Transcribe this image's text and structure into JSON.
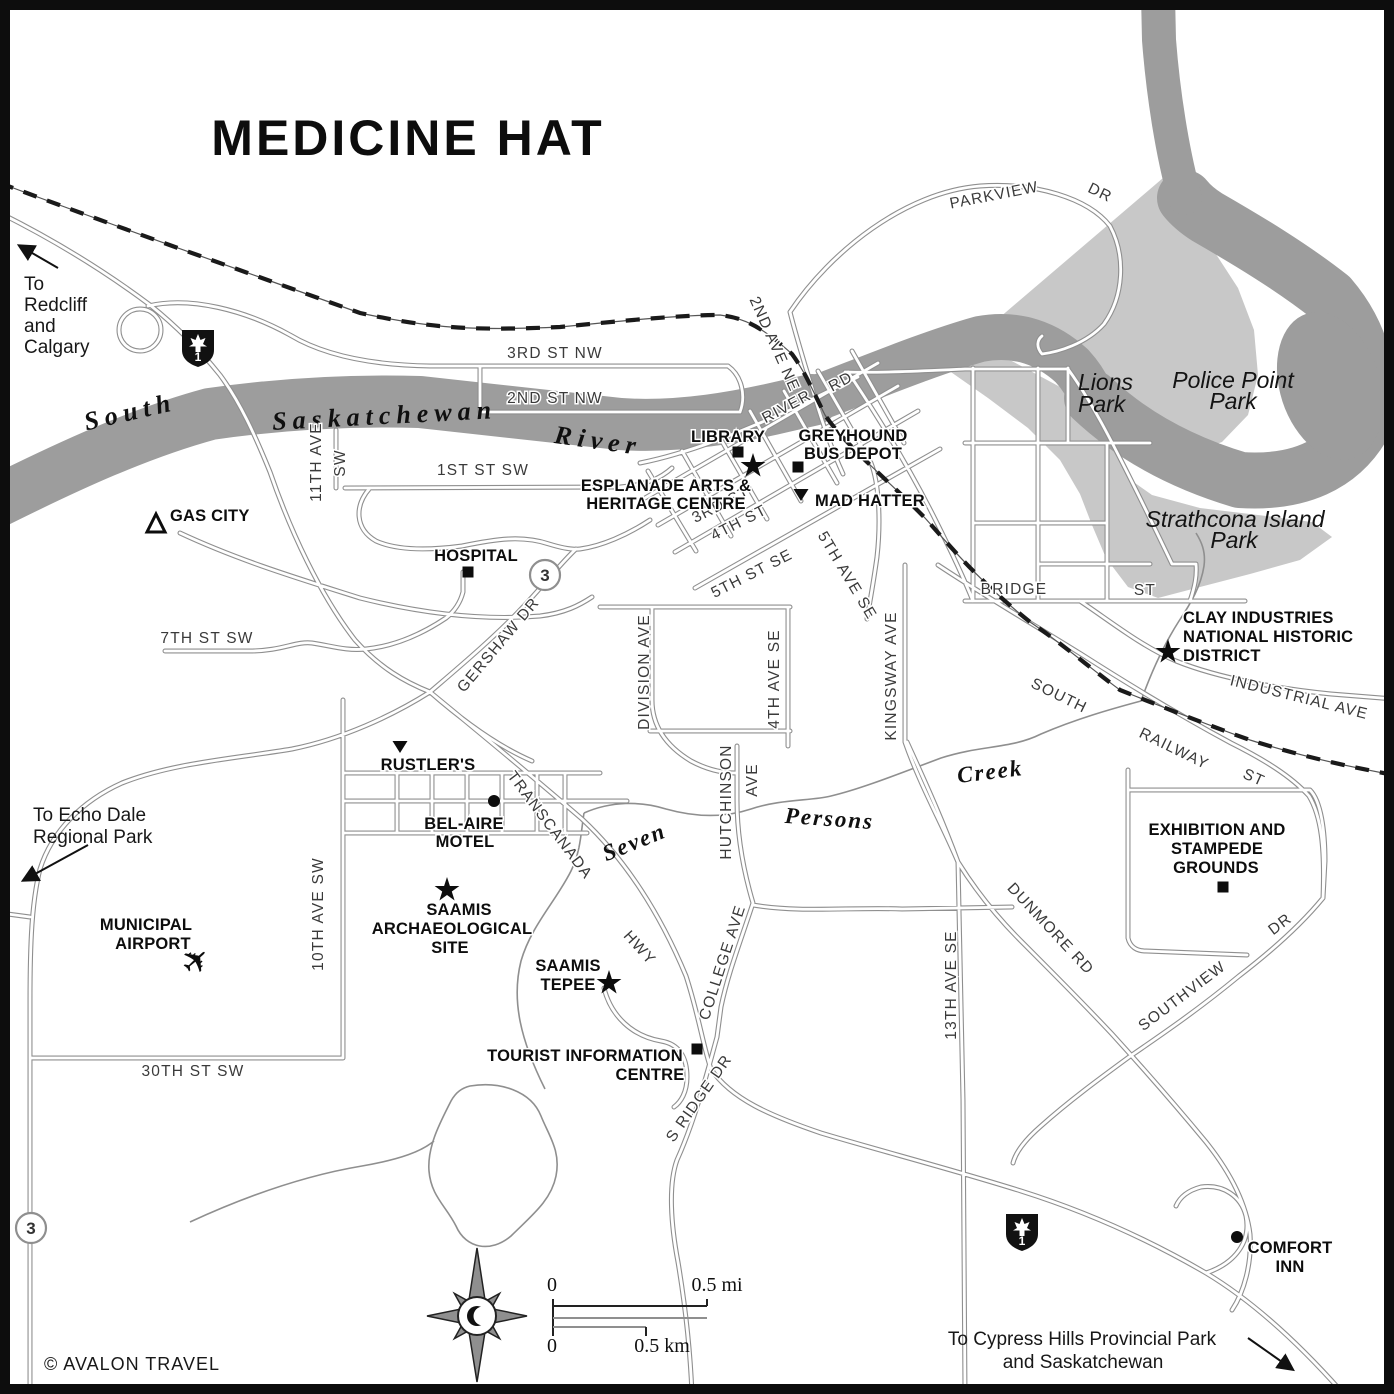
{
  "map": {
    "title": "MEDICINE HAT",
    "copyright": "© AVALON TRAVEL",
    "colors": {
      "river": "#9d9d9d",
      "park": "#c8c8c8",
      "road_casing": "#8f8f8f",
      "road_fill": "#ffffff",
      "rail": "#1a1a1a",
      "poi_text": "#0d0d0d",
      "street_text": "#3a3a3a"
    },
    "scalebar": {
      "mi_zero": "0",
      "mi_label": "0.5 mi",
      "km_zero": "0",
      "km_label": "0.5 km"
    },
    "compass": {
      "x": 477,
      "y": 1316,
      "icon": "compass-rose-crescent-moon"
    },
    "shields": [
      {
        "id": "hwy1-nw",
        "label": "1",
        "x": 198,
        "y": 348
      },
      {
        "id": "hwy1-se",
        "label": "1",
        "x": 1022,
        "y": 1232
      }
    ],
    "route_circles": [
      {
        "id": "hwy3-gershaw",
        "label": "3",
        "x": 545,
        "y": 575
      },
      {
        "id": "hwy3-south",
        "label": "3",
        "x": 31,
        "y": 1228
      }
    ],
    "arrows": [
      {
        "id": "arrow-to-redcliff",
        "x1": 58,
        "y1": 268,
        "x2": 20,
        "y2": 246
      },
      {
        "id": "arrow-to-echo-dale",
        "x1": 88,
        "y1": 845,
        "x2": 24,
        "y2": 880
      },
      {
        "id": "arrow-to-cypress",
        "x1": 1248,
        "y1": 1338,
        "x2": 1292,
        "y2": 1369
      }
    ],
    "markers": [
      {
        "type": "square",
        "name": "library-marker",
        "x": 738,
        "y": 452
      },
      {
        "type": "square",
        "name": "greyhound-bus-depot-marker",
        "x": 798,
        "y": 467
      },
      {
        "type": "square",
        "name": "hospital-marker",
        "x": 468,
        "y": 572
      },
      {
        "type": "square",
        "name": "tourist-information-marker",
        "x": 697,
        "y": 1049
      },
      {
        "type": "square",
        "name": "exhibition-grounds-marker",
        "x": 1223,
        "y": 887
      },
      {
        "type": "star",
        "name": "esplanade-marker",
        "x": 753,
        "y": 466
      },
      {
        "type": "star",
        "name": "saamis-archaeological-marker",
        "x": 447,
        "y": 890
      },
      {
        "type": "star",
        "name": "saamis-tepee-marker",
        "x": 609,
        "y": 983
      },
      {
        "type": "star",
        "name": "clay-district-marker",
        "x": 1168,
        "y": 652
      },
      {
        "type": "tri-down",
        "name": "mad-hatter-marker",
        "x": 801,
        "y": 494
      },
      {
        "type": "tri-down",
        "name": "rustlers-marker",
        "x": 400,
        "y": 746
      },
      {
        "type": "dot",
        "name": "bel-aire-motel-marker",
        "x": 494,
        "y": 801
      },
      {
        "type": "dot",
        "name": "comfort-inn-marker",
        "x": 1237,
        "y": 1237
      },
      {
        "type": "tri-open",
        "name": "gas-city-campground-marker",
        "x": 156,
        "y": 525
      },
      {
        "type": "plane",
        "name": "municipal-airport-icon",
        "x": 197,
        "y": 962
      }
    ],
    "labels": [
      {
        "id": "map-title",
        "t": "MEDICINE HAT",
        "x": 408,
        "y": 155,
        "c": "t",
        "a": "middle"
      },
      {
        "id": "note-redcliff-1",
        "t": "To",
        "x": 24,
        "y": 290,
        "c": "n",
        "a": "start"
      },
      {
        "id": "note-redcliff-2",
        "t": "Redcliff",
        "x": 24,
        "y": 311,
        "c": "n",
        "a": "start"
      },
      {
        "id": "note-redcliff-3",
        "t": "and",
        "x": 24,
        "y": 332,
        "c": "n",
        "a": "start"
      },
      {
        "id": "note-redcliff-4",
        "t": "Calgary",
        "x": 24,
        "y": 353,
        "c": "n",
        "a": "start"
      },
      {
        "id": "note-echo-1",
        "t": "To Echo Dale",
        "x": 33,
        "y": 821,
        "c": "n",
        "a": "start"
      },
      {
        "id": "note-echo-2",
        "t": "Regional Park",
        "x": 33,
        "y": 843,
        "c": "n",
        "a": "start"
      },
      {
        "id": "note-cypress-1",
        "t": "To Cypress Hills Provincial Park",
        "x": 1082,
        "y": 1345,
        "c": "n",
        "a": "middle"
      },
      {
        "id": "note-cypress-2",
        "t": "and Saskatchewan",
        "x": 1083,
        "y": 1368,
        "c": "n",
        "a": "middle"
      },
      {
        "id": "copyright",
        "t": "© AVALON TRAVEL",
        "x": 44,
        "y": 1370,
        "c": "c",
        "a": "start"
      },
      {
        "id": "river-south",
        "t": "South",
        "x": 132,
        "y": 420,
        "r": -13,
        "c": "w",
        "a": "middle"
      },
      {
        "id": "river-saskatchewan",
        "t": "Saskatchewan",
        "x": 385,
        "y": 424,
        "r": -3,
        "c": "w",
        "a": "middle"
      },
      {
        "id": "river-river",
        "t": "River",
        "x": 597,
        "y": 449,
        "r": 8,
        "c": "w",
        "a": "middle"
      },
      {
        "id": "creek-seven",
        "t": "Seven",
        "x": 637,
        "y": 849,
        "r": -22,
        "c": "k",
        "a": "middle"
      },
      {
        "id": "creek-persons",
        "t": "Persons",
        "x": 829,
        "y": 826,
        "r": 4,
        "c": "k",
        "a": "middle"
      },
      {
        "id": "creek-creek",
        "t": "Creek",
        "x": 991,
        "y": 779,
        "r": -7,
        "c": "k",
        "a": "middle"
      },
      {
        "id": "lions-park-1",
        "t": "Lions",
        "x": 1078,
        "y": 390,
        "c": "p",
        "a": "start"
      },
      {
        "id": "lions-park-2",
        "t": "Park",
        "x": 1078,
        "y": 412,
        "c": "p",
        "a": "start"
      },
      {
        "id": "police-point-1",
        "t": "Police Point",
        "x": 1233,
        "y": 388,
        "c": "p",
        "a": "middle"
      },
      {
        "id": "police-point-2",
        "t": "Park",
        "x": 1233,
        "y": 409,
        "c": "p",
        "a": "middle"
      },
      {
        "id": "strathcona-1",
        "t": "Strathcona Island",
        "x": 1235,
        "y": 527,
        "c": "p",
        "a": "middle"
      },
      {
        "id": "strathcona-2",
        "t": "Park",
        "x": 1234,
        "y": 548,
        "c": "p",
        "a": "middle"
      },
      {
        "id": "st-parkview",
        "t": "PARKVIEW",
        "x": 995,
        "y": 200,
        "r": -11,
        "c": "s",
        "a": "middle"
      },
      {
        "id": "st-parkview-dr",
        "t": "DR",
        "x": 1098,
        "y": 197,
        "r": 26,
        "c": "s",
        "a": "middle"
      },
      {
        "id": "st-3rd-nw",
        "t": "3RD   ST   NW",
        "x": 555,
        "y": 358,
        "c": "s",
        "a": "middle"
      },
      {
        "id": "st-2nd-nw",
        "t": "2ND   ST   NW",
        "x": 555,
        "y": 403,
        "c": "s",
        "a": "middle"
      },
      {
        "id": "st-2nd-ave-ne",
        "t": "2ND AVE NE",
        "x": 770,
        "y": 346,
        "r": 66,
        "c": "s",
        "a": "middle"
      },
      {
        "id": "st-river",
        "t": "RIVER",
        "x": 789,
        "y": 411,
        "r": -28,
        "c": "s",
        "a": "middle"
      },
      {
        "id": "st-river-rd",
        "t": "RD",
        "x": 843,
        "y": 386,
        "r": -28,
        "c": "s",
        "a": "middle"
      },
      {
        "id": "st-1st-sw",
        "t": "1ST   ST   SW",
        "x": 483,
        "y": 475,
        "c": "s",
        "a": "middle"
      },
      {
        "id": "st-11th-ave",
        "t": "11TH AVE",
        "x": 321,
        "y": 462,
        "r": -90,
        "c": "s",
        "a": "middle"
      },
      {
        "id": "st-11th-sw",
        "t": "SW",
        "x": 345,
        "y": 463,
        "r": -90,
        "c": "s",
        "a": "middle"
      },
      {
        "id": "st-3rd",
        "t": "3RD  ST",
        "x": 723,
        "y": 509,
        "r": -27,
        "c": "s",
        "a": "middle"
      },
      {
        "id": "st-4th",
        "t": "4TH  ST",
        "x": 741,
        "y": 527,
        "r": -27,
        "c": "s",
        "a": "middle"
      },
      {
        "id": "st-5th-se",
        "t": "5TH  ST  SE",
        "x": 754,
        "y": 578,
        "r": -27,
        "c": "s",
        "a": "middle"
      },
      {
        "id": "st-5th-ave",
        "t": "5TH AVE SE",
        "x": 843,
        "y": 578,
        "r": 59,
        "c": "s",
        "a": "middle"
      },
      {
        "id": "st-division",
        "t": "DIVISION AVE",
        "x": 649,
        "y": 672,
        "r": -90,
        "c": "s",
        "a": "middle"
      },
      {
        "id": "st-4th-ave-se",
        "t": "4TH AVE SE",
        "x": 779,
        "y": 679,
        "r": -90,
        "c": "s",
        "a": "middle"
      },
      {
        "id": "st-kingsway",
        "t": "KINGSWAY AVE",
        "x": 896,
        "y": 676,
        "r": -90,
        "c": "s",
        "a": "middle"
      },
      {
        "id": "st-bridge",
        "t": "BRIDGE",
        "x": 1014,
        "y": 594,
        "c": "s",
        "a": "middle"
      },
      {
        "id": "st-bridge-st",
        "t": "ST",
        "x": 1145,
        "y": 595,
        "c": "s",
        "a": "middle"
      },
      {
        "id": "st-gershaw",
        "t": "GERSHAW DR",
        "x": 502,
        "y": 648,
        "r": -50,
        "c": "s",
        "a": "middle"
      },
      {
        "id": "st-7th-sw",
        "t": "7TH ST SW",
        "x": 207,
        "y": 643,
        "c": "s",
        "a": "middle"
      },
      {
        "id": "st-south",
        "t": "SOUTH",
        "x": 1057,
        "y": 700,
        "r": 26,
        "c": "s",
        "a": "middle"
      },
      {
        "id": "st-railway",
        "t": "RAILWAY",
        "x": 1172,
        "y": 753,
        "r": 26,
        "c": "s",
        "a": "middle"
      },
      {
        "id": "st-railway-st",
        "t": "ST",
        "x": 1252,
        "y": 782,
        "r": 24,
        "c": "s",
        "a": "middle"
      },
      {
        "id": "st-industrial",
        "t": "INDUSTRIAL AVE",
        "x": 1298,
        "y": 702,
        "r": 14,
        "c": "s",
        "a": "middle"
      },
      {
        "id": "st-transcanada",
        "t": "TRANSCANADA",
        "x": 546,
        "y": 828,
        "r": 53,
        "c": "s",
        "a": "middle"
      },
      {
        "id": "st-hwy",
        "t": "HWY",
        "x": 636,
        "y": 951,
        "r": 48,
        "c": "s",
        "a": "middle"
      },
      {
        "id": "st-hutchinson",
        "t": "HUTCHINSON",
        "x": 731,
        "y": 802,
        "r": -90,
        "c": "s",
        "a": "middle"
      },
      {
        "id": "st-hutchinson-ave",
        "t": "AVE",
        "x": 757,
        "y": 780,
        "r": -90,
        "c": "s",
        "a": "middle"
      },
      {
        "id": "st-college",
        "t": "COLLEGE AVE",
        "x": 727,
        "y": 964,
        "r": -72,
        "c": "s",
        "a": "middle"
      },
      {
        "id": "st-10th-ave",
        "t": "10TH  AVE SW",
        "x": 323,
        "y": 914,
        "r": -90,
        "c": "s",
        "a": "middle"
      },
      {
        "id": "st-30th-sw",
        "t": "30TH  ST  SW",
        "x": 193,
        "y": 1076,
        "c": "s",
        "a": "middle"
      },
      {
        "id": "st-13th-ave",
        "t": "13TH  AVE  SE",
        "x": 956,
        "y": 985,
        "r": -90,
        "c": "s",
        "a": "middle"
      },
      {
        "id": "st-dunmore",
        "t": "DUNMORE  RD",
        "x": 1047,
        "y": 932,
        "r": 47,
        "c": "s",
        "a": "middle"
      },
      {
        "id": "st-southview",
        "t": "SOUTHVIEW",
        "x": 1185,
        "y": 1000,
        "r": -37,
        "c": "s",
        "a": "middle"
      },
      {
        "id": "st-southview-dr",
        "t": "DR",
        "x": 1283,
        "y": 928,
        "r": -37,
        "c": "s",
        "a": "middle"
      },
      {
        "id": "st-s-ridge",
        "t": "S RIDGE DR",
        "x": 703,
        "y": 1101,
        "r": -55,
        "c": "s",
        "a": "middle"
      },
      {
        "id": "poi-library",
        "t": "LIBRARY",
        "x": 728,
        "y": 442,
        "c": "b",
        "a": "middle"
      },
      {
        "id": "poi-greyhound-1",
        "t": "GREYHOUND",
        "x": 853,
        "y": 441,
        "c": "b",
        "a": "middle"
      },
      {
        "id": "poi-greyhound-2",
        "t": "BUS DEPOT",
        "x": 853,
        "y": 459,
        "c": "b",
        "a": "middle"
      },
      {
        "id": "poi-esplanade-1",
        "t": "ESPLANADE ARTS &",
        "x": 666,
        "y": 491,
        "c": "b",
        "a": "middle"
      },
      {
        "id": "poi-esplanade-2",
        "t": "HERITAGE CENTRE",
        "x": 666,
        "y": 509,
        "c": "b",
        "a": "middle"
      },
      {
        "id": "poi-mad-hatter",
        "t": "MAD HATTER",
        "x": 815,
        "y": 506,
        "c": "b",
        "a": "start"
      },
      {
        "id": "poi-gas-city",
        "t": "GAS CITY",
        "x": 170,
        "y": 521,
        "c": "b",
        "a": "start"
      },
      {
        "id": "poi-hospital",
        "t": "HOSPITAL",
        "x": 476,
        "y": 561,
        "c": "b",
        "a": "middle"
      },
      {
        "id": "poi-rustlers",
        "t": "RUSTLER'S",
        "x": 428,
        "y": 770,
        "c": "b",
        "a": "middle"
      },
      {
        "id": "poi-belaire-1",
        "t": "BEL-AIRE",
        "x": 464,
        "y": 829,
        "c": "b",
        "a": "middle"
      },
      {
        "id": "poi-belaire-2",
        "t": "MOTEL",
        "x": 465,
        "y": 847,
        "c": "b",
        "a": "middle"
      },
      {
        "id": "poi-saamis-arch-1",
        "t": "SAAMIS",
        "x": 459,
        "y": 915,
        "c": "b",
        "a": "middle"
      },
      {
        "id": "poi-saamis-arch-2",
        "t": "ARCHAEOLOGICAL",
        "x": 452,
        "y": 934,
        "c": "b",
        "a": "middle"
      },
      {
        "id": "poi-saamis-arch-3",
        "t": "SITE",
        "x": 450,
        "y": 953,
        "c": "b",
        "a": "middle"
      },
      {
        "id": "poi-tepee-1",
        "t": "SAAMIS",
        "x": 568,
        "y": 971,
        "c": "b",
        "a": "middle"
      },
      {
        "id": "poi-tepee-2",
        "t": "TEPEE",
        "x": 568,
        "y": 990,
        "c": "b",
        "a": "middle"
      },
      {
        "id": "poi-tourist-1",
        "t": "TOURIST INFORMATION",
        "x": 585,
        "y": 1061,
        "c": "b",
        "a": "middle"
      },
      {
        "id": "poi-tourist-2",
        "t": "CENTRE",
        "x": 650,
        "y": 1080,
        "c": "b",
        "a": "middle"
      },
      {
        "id": "poi-airport-1",
        "t": "MUNICIPAL",
        "x": 146,
        "y": 930,
        "c": "b",
        "a": "middle"
      },
      {
        "id": "poi-airport-2",
        "t": "AIRPORT",
        "x": 153,
        "y": 949,
        "c": "b",
        "a": "middle"
      },
      {
        "id": "poi-clay-1",
        "t": "CLAY INDUSTRIES",
        "x": 1183,
        "y": 623,
        "c": "b",
        "a": "start"
      },
      {
        "id": "poi-clay-2",
        "t": "NATIONAL HISTORIC",
        "x": 1183,
        "y": 642,
        "c": "b",
        "a": "start"
      },
      {
        "id": "poi-clay-3",
        "t": "DISTRICT",
        "x": 1183,
        "y": 661,
        "c": "b",
        "a": "start"
      },
      {
        "id": "poi-exhibition-1",
        "t": "EXHIBITION AND",
        "x": 1217,
        "y": 835,
        "c": "b",
        "a": "middle"
      },
      {
        "id": "poi-exhibition-2",
        "t": "STAMPEDE",
        "x": 1217,
        "y": 854,
        "c": "b",
        "a": "middle"
      },
      {
        "id": "poi-exhibition-3",
        "t": "GROUNDS",
        "x": 1216,
        "y": 873,
        "c": "b",
        "a": "middle"
      },
      {
        "id": "poi-comfort-1",
        "t": "COMFORT",
        "x": 1290,
        "y": 1253,
        "c": "b",
        "a": "middle"
      },
      {
        "id": "poi-comfort-2",
        "t": "INN",
        "x": 1290,
        "y": 1272,
        "c": "b",
        "a": "middle"
      },
      {
        "id": "scale-mi-0",
        "t": "0",
        "x": 552,
        "y": 1291,
        "c": "m",
        "a": "middle"
      },
      {
        "id": "scale-mi",
        "t": "0.5 mi",
        "x": 717,
        "y": 1291,
        "c": "m",
        "a": "middle"
      },
      {
        "id": "scale-km-0",
        "t": "0",
        "x": 552,
        "y": 1352,
        "c": "m",
        "a": "middle"
      },
      {
        "id": "scale-km",
        "t": "0.5 km",
        "x": 662,
        "y": 1352,
        "c": "m",
        "a": "middle"
      }
    ]
  }
}
